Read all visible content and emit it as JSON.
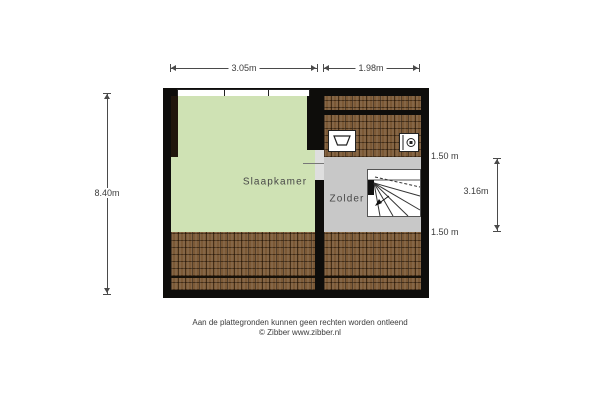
{
  "colors": {
    "floor_green": "#cfe2b4",
    "floor_gray": "#c8c8c8",
    "floor_wood": "#7b5936",
    "wall": "#0e0d0b",
    "dim_text": "#3c3c3c"
  },
  "floorplan": {
    "rooms": [
      {
        "label": "Slaapkamer",
        "floor": "green"
      },
      {
        "label": "Zolder",
        "floor": "gray"
      }
    ],
    "fixtures": [
      {
        "icon": "window-icon"
      },
      {
        "icon": "sink-icon"
      },
      {
        "icon": "ventilation-unit-icon"
      },
      {
        "icon": "staircase-icon"
      }
    ],
    "dimensions": {
      "top_width_left": "3.05m",
      "top_width_right": "1.98m",
      "left_height": "8.40m",
      "right_top_marker": "1.50 m",
      "right_middle": "3.16m",
      "right_bottom_marker": "1.50 m"
    },
    "footer_line1": "Aan de plattegronden kunnen geen rechten worden ontleend",
    "footer_line2": "© Zibber www.zibber.nl"
  }
}
